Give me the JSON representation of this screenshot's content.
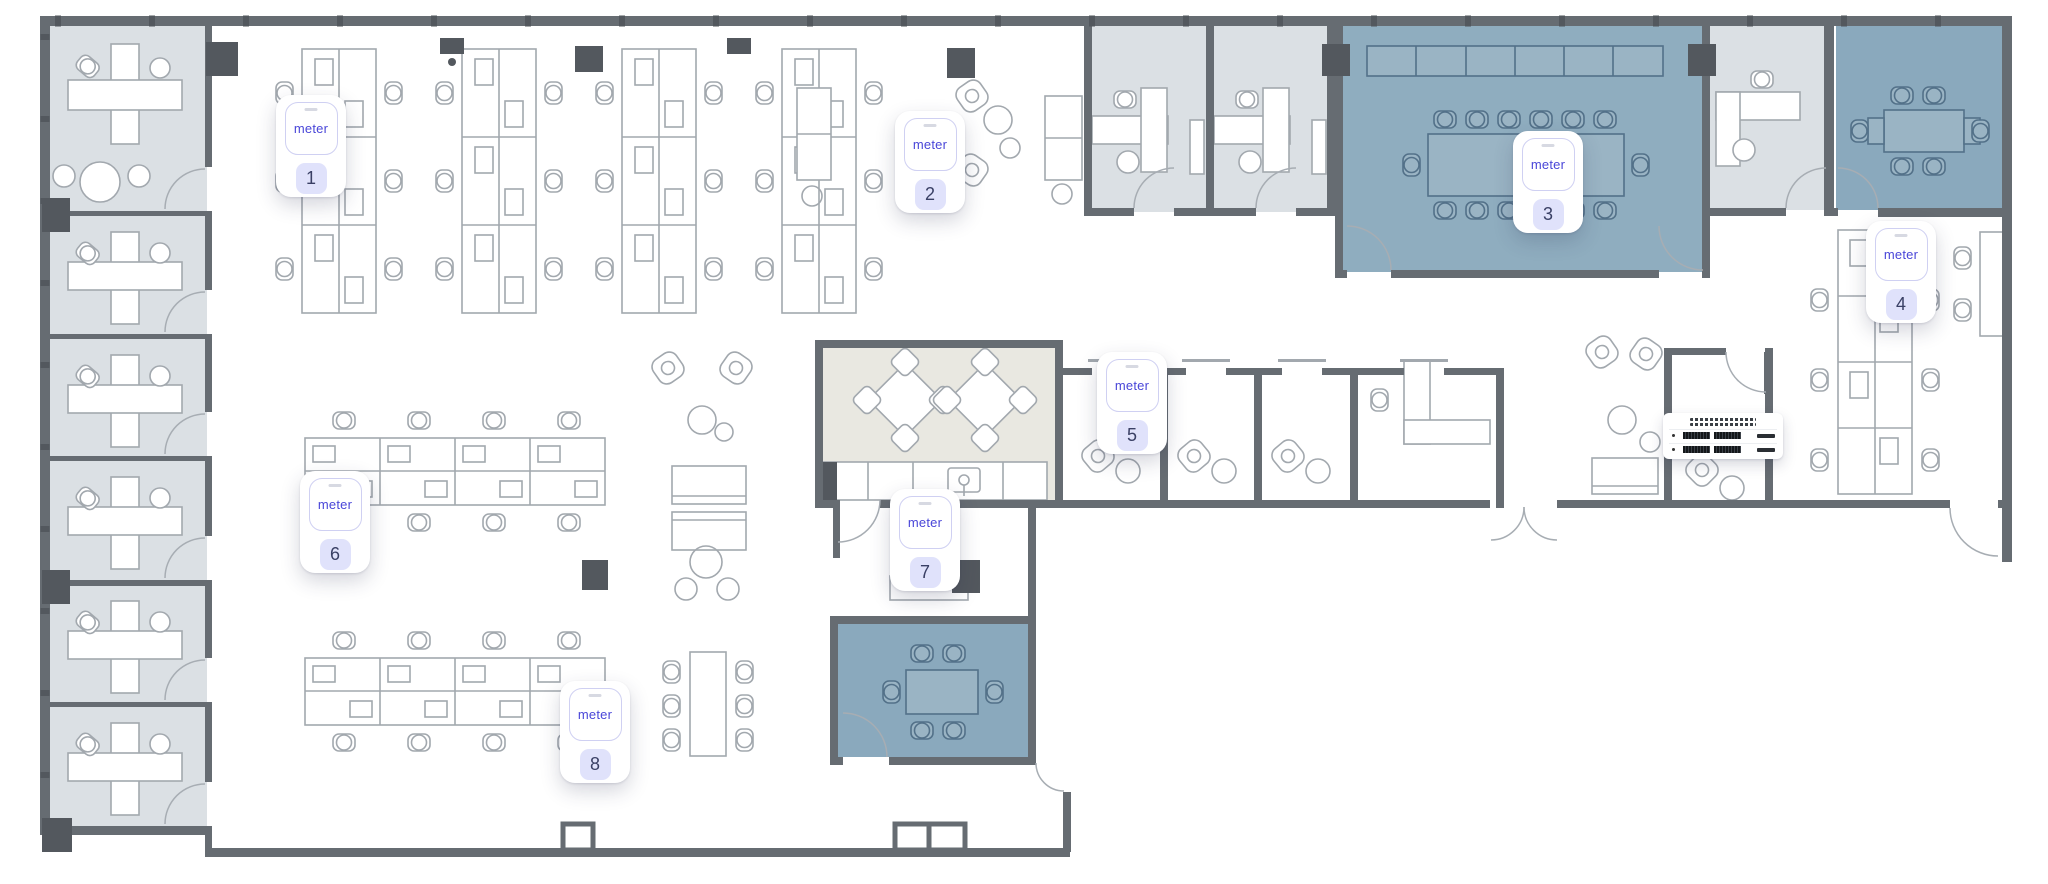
{
  "view": {
    "name": "office-floor-plan",
    "width": 2048,
    "height": 884
  },
  "brand": {
    "wordmark": "meter"
  },
  "colors": {
    "accent": "#4946d8",
    "badge_bg": "#e0e2fb",
    "badge_text": "#3a4065",
    "card_bg": "#ffffff",
    "wall": "#666c72",
    "column": "#53585e",
    "furniture": "#a2a8ae",
    "furniture_blue": "#537189",
    "furniture_blue_fill": "#9ab4c4",
    "room_gray": "#dbe0e4",
    "room_blue": "#8fadbf",
    "room_blue_dark": "#8aa9bd",
    "room_beige": "#e9e8e1"
  },
  "devices": [
    {
      "number": "1",
      "x": 276,
      "y": 95
    },
    {
      "number": "2",
      "x": 895,
      "y": 111
    },
    {
      "number": "3",
      "x": 1513,
      "y": 131
    },
    {
      "number": "4",
      "x": 1866,
      "y": 221
    },
    {
      "number": "5",
      "x": 1097,
      "y": 352
    },
    {
      "number": "6",
      "x": 300,
      "y": 471
    },
    {
      "number": "7",
      "x": 890,
      "y": 489
    },
    {
      "number": "8",
      "x": 560,
      "y": 681
    }
  ],
  "rack": {
    "x": 1663,
    "y": 413
  }
}
